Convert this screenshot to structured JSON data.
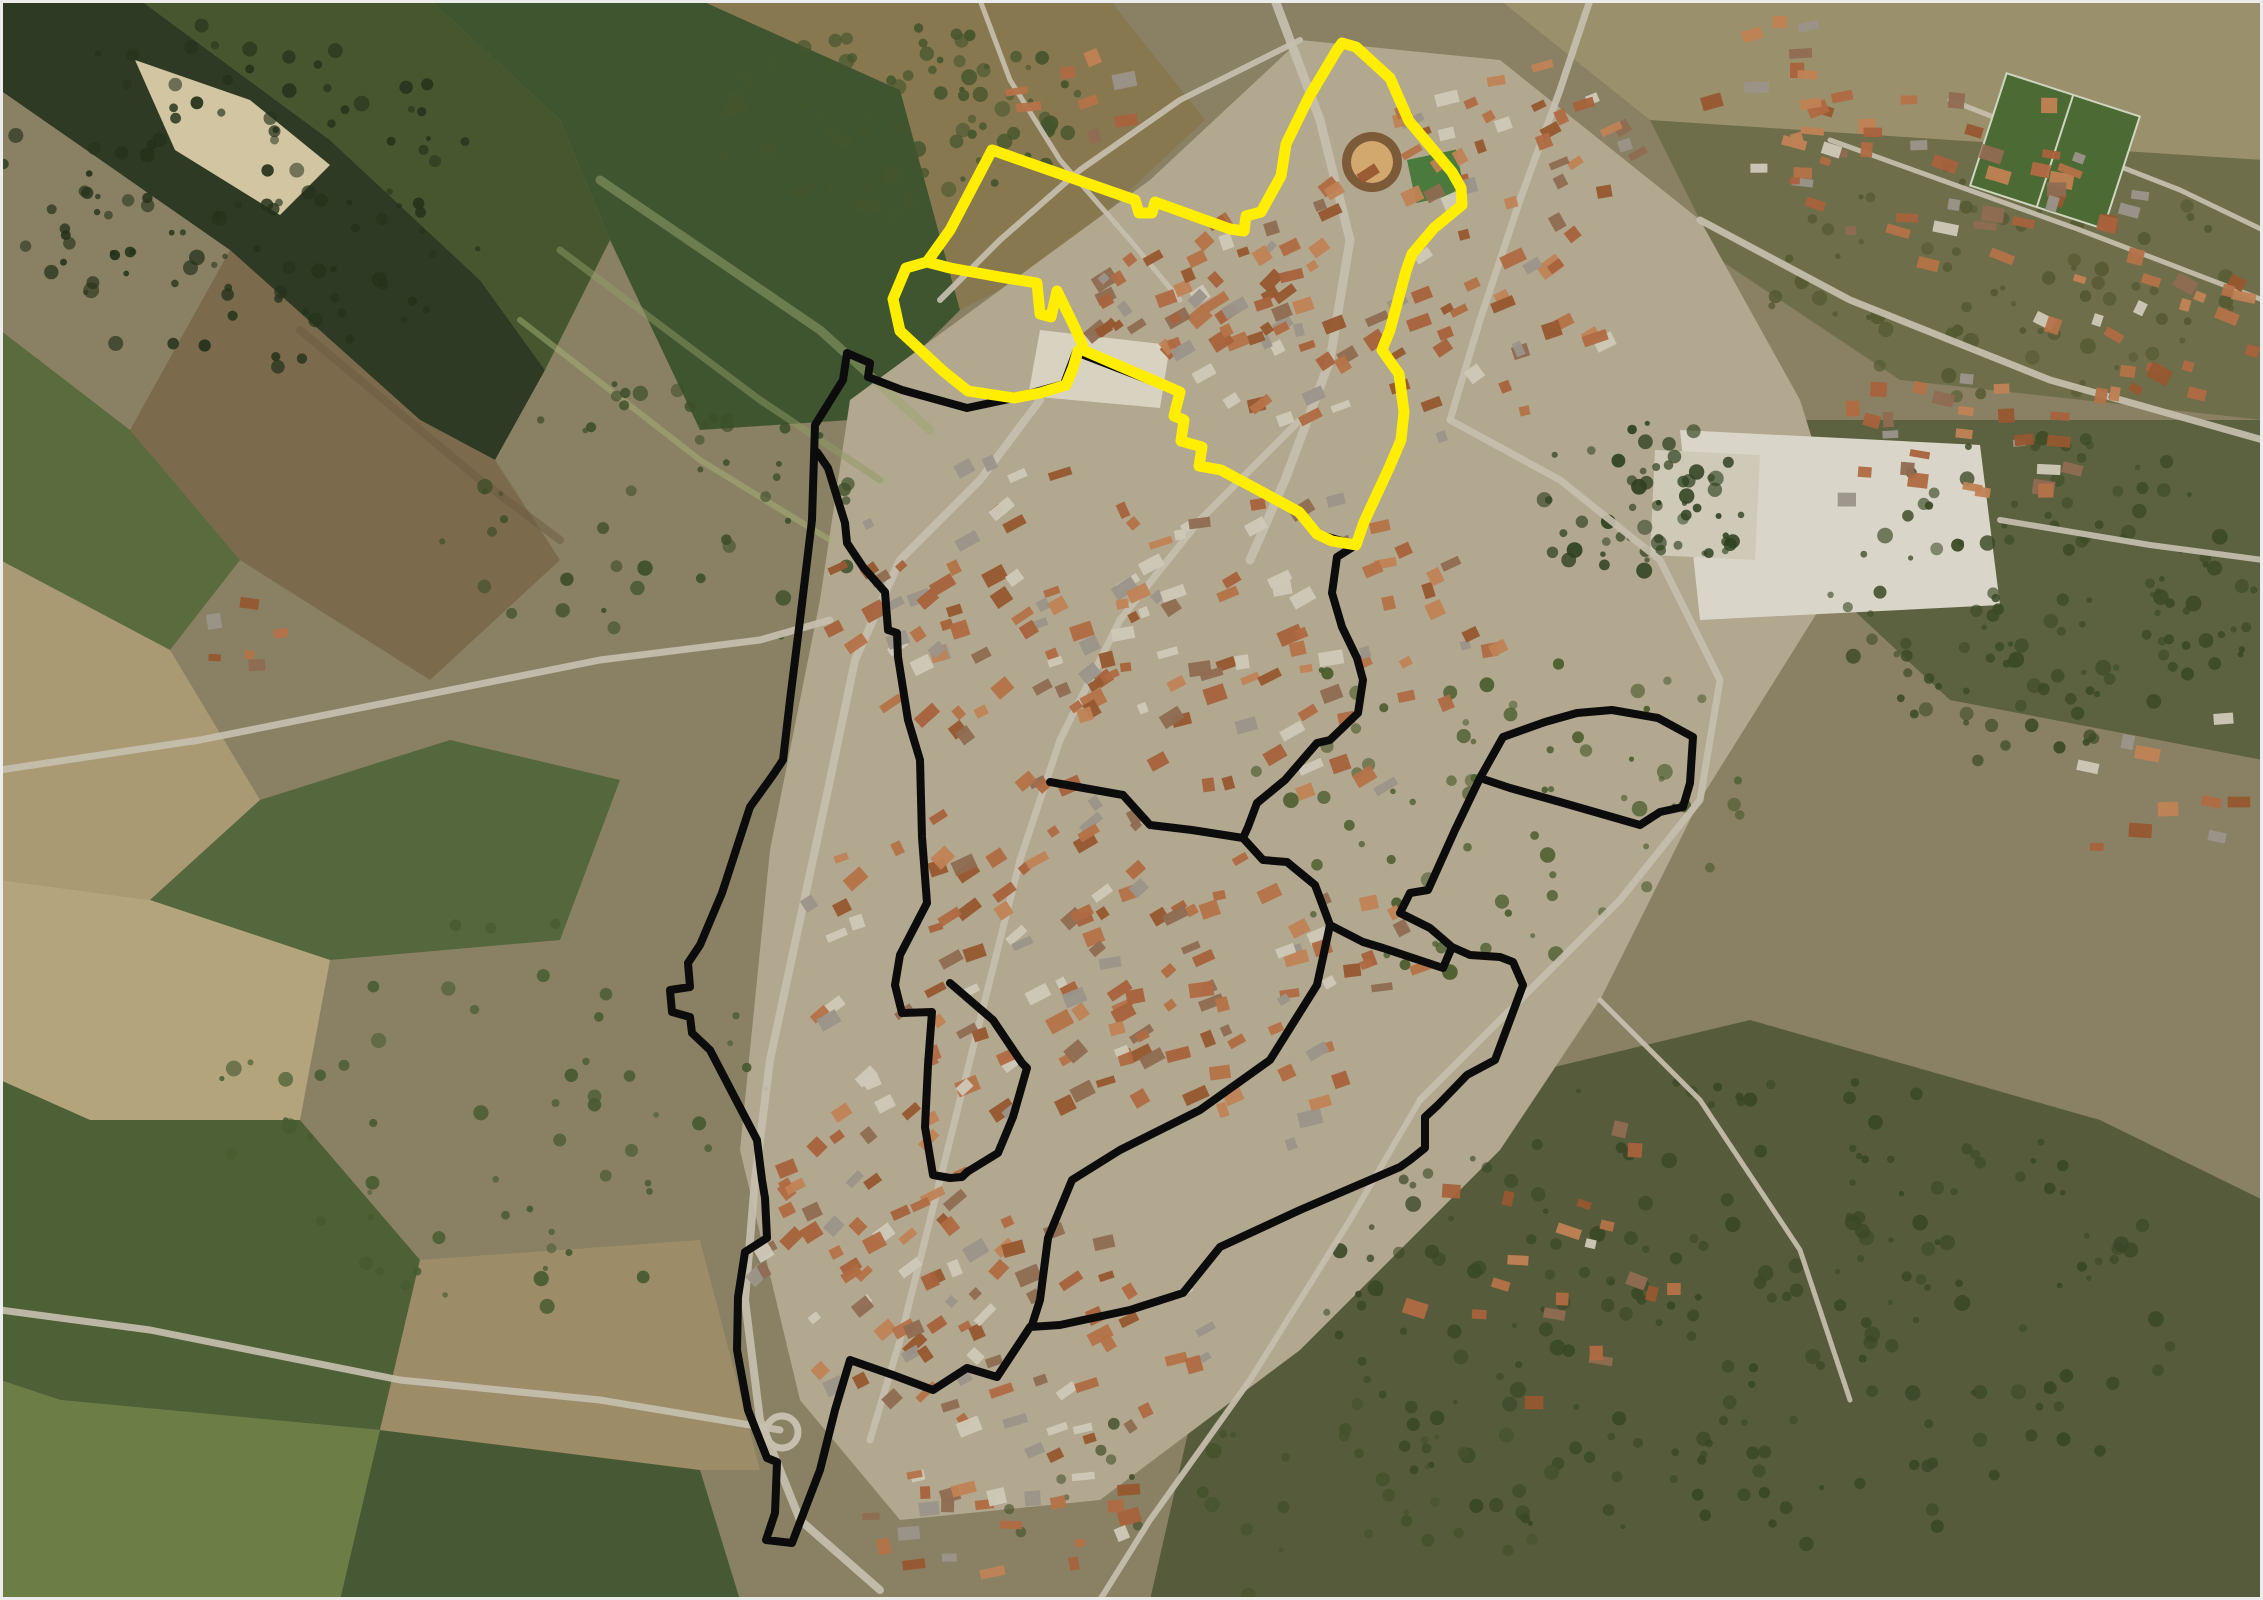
{
  "meta": {
    "kind": "aerial-satellite-map",
    "width": 2263,
    "height": 1600,
    "frame_border_color": "#ececec"
  },
  "palette": {
    "base": "#8a8164",
    "roads": "#c6bfae",
    "road_minor": "#bdb5a3",
    "roof_colors": [
      "#a8623c",
      "#b57248",
      "#97572f",
      "#c08254",
      "#8f6b52",
      "#cfc8b8",
      "#9b948a",
      "#b06a42"
    ],
    "tree_dark": "#32441f",
    "tree_mid": "#4a5c2d",
    "boundary_yellow": "#ffee00",
    "boundary_black": "#0c0c0c"
  },
  "map": {
    "regions": [
      {
        "name": "riparian-forest",
        "fill": "#2e3a24",
        "pts": "0,0 140,0 330,140 480,280 545,370 495,460 420,420 230,250 0,90"
      },
      {
        "name": "river-sandbar",
        "fill": "#d2c5a2",
        "pts": "135,60 250,100 330,165 280,215 175,150"
      },
      {
        "name": "green-field-nw",
        "fill": "#46572f",
        "pts": "140,0 430,0 560,120 610,240 545,370 480,280 330,140"
      },
      {
        "name": "green-field-north",
        "fill": "#3e5530",
        "pts": "430,0 700,0 900,90 960,310 850,420 700,430 610,240 560,120"
      },
      {
        "name": "orchard-plot-north",
        "fill": "#887850",
        "pts": "700,0 1110,0 1205,120 1050,265 960,310 900,90"
      },
      {
        "name": "plowed-field-west",
        "fill": "#7c6a4d",
        "pts": "230,250 420,420 495,460 560,560 430,680 240,560 130,430"
      },
      {
        "name": "green-strip-west",
        "fill": "#5a6b3d",
        "pts": "0,330 130,430 240,560 170,650 0,560"
      },
      {
        "name": "pale-field-west",
        "fill": "#a99a74",
        "pts": "0,560 170,650 260,800 150,900 0,880"
      },
      {
        "name": "green-field-west-mid",
        "fill": "#55673c",
        "pts": "260,800 450,740 620,780 560,940 330,960 150,900"
      },
      {
        "name": "pale-field-sw",
        "fill": "#b3a47c",
        "pts": "0,880 150,900 330,960 300,1120 90,1120 0,1080"
      },
      {
        "name": "green-field-sw1",
        "fill": "#4e6136",
        "pts": "0,1080 90,1120 300,1120 420,1260 380,1430 60,1400 0,1380"
      },
      {
        "name": "green-field-sw2",
        "fill": "#6d7d46",
        "pts": "0,1380 60,1400 380,1430 340,1600 0,1600"
      },
      {
        "name": "green-field-south",
        "fill": "#465934",
        "pts": "380,1430 700,1470 740,1600 340,1600"
      },
      {
        "name": "tan-fields-south",
        "fill": "#9c8d68",
        "pts": "420,1260 700,1240 760,1470 700,1470 380,1430"
      },
      {
        "name": "pale-field-ne",
        "fill": "#9b906c",
        "pts": "1500,0 2263,0 2263,160 1950,140 1650,120"
      },
      {
        "name": "scrub-ne",
        "fill": "#6f6e4a",
        "pts": "1650,120 1950,140 2263,160 2263,420 1900,380 1720,260"
      },
      {
        "name": "woods-east",
        "fill": "#5c6140",
        "pts": "1750,420 2263,420 2263,760 1950,700 1800,560"
      },
      {
        "name": "woods-southeast",
        "fill": "#565c3b",
        "pts": "1500,1080 1750,1020 2100,1120 2263,1200 2263,1600 1150,1600 1200,1380 1350,1220"
      },
      {
        "name": "town-ground",
        "fill": "#b2a78f",
        "pts": "850,400 1150,180 1300,40 1500,60 1700,220 1800,400 1850,560 1700,800 1600,1000 1500,1150 1300,1350 1100,1500 900,1520 800,1400 740,1150 770,850 820,600"
      },
      {
        "name": "central-plaza",
        "fill": "#d8d2c0",
        "pts": "1040,330 1170,345 1160,408 1028,396"
      },
      {
        "name": "school-complex",
        "fill": "#d9d6c9",
        "pts": "1680,430 1980,445 2000,605 1700,620"
      },
      {
        "name": "supermarket-lot",
        "fill": "#cfc9b8",
        "pts": "1655,450 1760,455 1755,560 1650,555"
      }
    ],
    "field_streaks": [
      {
        "name": "crop-row-streak",
        "stroke": "#9aa86f",
        "w": 9,
        "pts": "600,180 820,330 930,430"
      },
      {
        "name": "crop-row-streak",
        "stroke": "#8d9c64",
        "w": 7,
        "pts": "560,250 760,400 880,480"
      },
      {
        "name": "crop-row-streak",
        "stroke": "#a5b175",
        "w": 6,
        "pts": "520,320 700,460 830,540"
      },
      {
        "name": "plow-streak",
        "stroke": "#6b5a40",
        "w": 8,
        "pts": "300,330 480,480 560,540"
      }
    ],
    "roads": [
      {
        "name": "road-main-north",
        "w": 9,
        "pts": "1275,0 1320,120 1350,240 1330,360 1285,480 1250,560"
      },
      {
        "name": "road-west-bypass",
        "w": 8,
        "pts": "1040,400 980,480 900,560 855,660 830,780 800,920 770,1060 755,1180 745,1300 760,1420 800,1520 880,1590"
      },
      {
        "name": "road-inner-street",
        "w": 7,
        "pts": "1300,420 1200,520 1120,620 1060,740 1020,860 990,980 960,1100 930,1220 900,1340 870,1440"
      },
      {
        "name": "road-northeast-in",
        "w": 7,
        "pts": "1590,0 1560,90 1520,200 1480,320 1450,420"
      },
      {
        "name": "road-ne-diagonal",
        "w": 7,
        "pts": "1700,220 1850,300 2050,380 2263,440"
      },
      {
        "name": "road-ring-east",
        "w": 7,
        "pts": "1450,420 1560,480 1660,560 1720,680 1700,800 1620,900 1520,1000 1420,1100"
      },
      {
        "name": "road-west-out",
        "w": 7,
        "pts": "0,770 200,740 400,700 600,660 760,640 830,620"
      },
      {
        "name": "road-southwest-out",
        "w": 7,
        "pts": "780,1430 600,1400 400,1380 150,1330 0,1310"
      },
      {
        "name": "road-se-1",
        "w": 6,
        "pts": "1420,1100 1350,1220 1250,1380 1150,1520 1100,1600"
      },
      {
        "name": "road-se-2",
        "w": 5,
        "pts": "1600,1000 1700,1100 1800,1250 1850,1400"
      },
      {
        "name": "road-farm-top",
        "w": 5,
        "pts": "980,0 1010,80 1060,160 1130,240 1180,300"
      },
      {
        "name": "road-ne-suburb-1",
        "w": 5,
        "pts": "1830,140 2080,230 2263,300"
      },
      {
        "name": "road-ne-suburb-2",
        "w": 5,
        "pts": "1950,100 2180,190 2263,230"
      },
      {
        "name": "road-school-east",
        "w": 6,
        "pts": "2000,520 2150,545 2263,560"
      },
      {
        "name": "road-top-center",
        "w": 6,
        "pts": "1300,40 1180,100 1080,170 1000,240 940,300"
      }
    ],
    "landmarks": {
      "bullring": {
        "name": "bullring",
        "cx": 1372,
        "cy": 162,
        "r_outer": 30,
        "r_inner": 21,
        "ring_fill": "#7d5a38",
        "sand_fill": "#d2a86e"
      },
      "green_pitch": {
        "name": "small-green-pitch",
        "x": 1407,
        "y": 160,
        "w": 50,
        "h": 44,
        "fill": "#4a7a3c"
      },
      "soccer_field": {
        "name": "soccer-field",
        "x": 1985,
        "y": 92,
        "w": 140,
        "h": 118,
        "fill": "#4c6a34",
        "line": "#cfd6c0"
      },
      "roundabout": {
        "name": "roundabout",
        "cx": 782,
        "cy": 1432,
        "r": 16,
        "stroke": "#c6bfae"
      }
    },
    "building_clusters": [
      {
        "name": "town-street-row-north",
        "cx": 1200,
        "cy": 300,
        "rx": 130,
        "ry": 70,
        "n": 35,
        "ang": -35,
        "seed": 11
      },
      {
        "name": "town-core-north",
        "cx": 1390,
        "cy": 300,
        "rx": 230,
        "ry": 150,
        "n": 80,
        "ang": -25,
        "seed": 12
      },
      {
        "name": "town-mid-west",
        "cx": 1000,
        "cy": 600,
        "rx": 180,
        "ry": 140,
        "n": 70,
        "ang": -30,
        "seed": 13
      },
      {
        "name": "town-mid-east",
        "cx": 1300,
        "cy": 650,
        "rx": 200,
        "ry": 160,
        "n": 70,
        "ang": -20,
        "seed": 14
      },
      {
        "name": "town-south-1",
        "cx": 1000,
        "cy": 950,
        "rx": 200,
        "ry": 180,
        "n": 85,
        "ang": -30,
        "seed": 15
      },
      {
        "name": "town-south-2",
        "cx": 1250,
        "cy": 1000,
        "rx": 180,
        "ry": 150,
        "n": 55,
        "ang": -20,
        "seed": 16
      },
      {
        "name": "town-sw-tail",
        "cx": 880,
        "cy": 1250,
        "rx": 130,
        "ry": 180,
        "n": 60,
        "ang": -35,
        "seed": 17
      },
      {
        "name": "town-s-tail",
        "cx": 1050,
        "cy": 1350,
        "rx": 160,
        "ry": 120,
        "n": 40,
        "ang": -25,
        "seed": 18
      },
      {
        "name": "suburb-ne-1",
        "cx": 1950,
        "cy": 180,
        "rx": 200,
        "ry": 90,
        "n": 45,
        "ang": 10,
        "seed": 19
      },
      {
        "name": "suburb-ne-2",
        "cx": 2150,
        "cy": 330,
        "rx": 110,
        "ry": 80,
        "n": 25,
        "ang": 20,
        "seed": 20
      },
      {
        "name": "apartment-blocks-east",
        "cx": 1950,
        "cy": 450,
        "rx": 140,
        "ry": 80,
        "n": 28,
        "ang": 5,
        "seed": 21
      },
      {
        "name": "village-north",
        "cx": 1520,
        "cy": 130,
        "rx": 140,
        "ry": 80,
        "n": 30,
        "ang": -20,
        "seed": 22
      },
      {
        "name": "farm-north",
        "cx": 1075,
        "cy": 95,
        "rx": 60,
        "ry": 50,
        "n": 8,
        "ang": -15,
        "seed": 23
      },
      {
        "name": "houses-far-east",
        "cx": 2150,
        "cy": 770,
        "rx": 110,
        "ry": 90,
        "n": 10,
        "ang": 0,
        "seed": 24
      },
      {
        "name": "houses-se-sparse",
        "cx": 1600,
        "cy": 1270,
        "rx": 200,
        "ry": 150,
        "n": 20,
        "ang": 10,
        "seed": 25
      },
      {
        "name": "houses-bottom",
        "cx": 1000,
        "cy": 1520,
        "rx": 150,
        "ry": 60,
        "n": 25,
        "ang": -10,
        "seed": 26
      },
      {
        "name": "hamlet-west",
        "cx": 260,
        "cy": 650,
        "rx": 80,
        "ry": 50,
        "n": 6,
        "ang": 0,
        "seed": 27
      },
      {
        "name": "houses-ne-far",
        "cx": 1780,
        "cy": 80,
        "rx": 90,
        "ry": 60,
        "n": 12,
        "ang": -10,
        "seed": 28
      }
    ],
    "tree_zones": [
      {
        "name": "riparian-trees",
        "cx": 240,
        "cy": 200,
        "rx": 250,
        "ry": 180,
        "n": 120,
        "fill": "#25331b",
        "seed": 31
      },
      {
        "name": "east-woods-trees",
        "cx": 2050,
        "cy": 600,
        "rx": 220,
        "ry": 170,
        "n": 130,
        "fill": "#3c4a26",
        "seed": 32
      },
      {
        "name": "se-woods-trees",
        "cx": 1750,
        "cy": 1320,
        "rx": 430,
        "ry": 250,
        "n": 220,
        "fill": "#3a4826",
        "seed": 33
      },
      {
        "name": "central-park-trees",
        "cx": 1640,
        "cy": 500,
        "rx": 120,
        "ry": 80,
        "n": 60,
        "fill": "#2f4220",
        "seed": 34
      },
      {
        "name": "mid-scatter-trees",
        "cx": 1500,
        "cy": 800,
        "rx": 260,
        "ry": 180,
        "n": 70,
        "fill": "#4a5c2d",
        "seed": 35
      },
      {
        "name": "orchard-trees",
        "cx": 900,
        "cy": 120,
        "rx": 190,
        "ry": 100,
        "n": 90,
        "fill": "#44552c",
        "seed": 36
      },
      {
        "name": "sw-scatter-trees",
        "cx": 500,
        "cy": 1100,
        "rx": 280,
        "ry": 210,
        "n": 60,
        "fill": "#465a30",
        "seed": 37
      },
      {
        "name": "field-hedge-trees",
        "cx": 650,
        "cy": 520,
        "rx": 210,
        "ry": 150,
        "n": 50,
        "fill": "#3d4f29",
        "seed": 38
      },
      {
        "name": "bottom-scatter-trees",
        "cx": 1300,
        "cy": 1500,
        "rx": 300,
        "ry": 100,
        "n": 40,
        "fill": "#45522c",
        "seed": 39
      },
      {
        "name": "ne-scrub-trees",
        "cx": 2000,
        "cy": 280,
        "rx": 240,
        "ry": 120,
        "n": 70,
        "fill": "#52582f",
        "seed": 40
      }
    ],
    "boundaries": {
      "yellow": {
        "name": "yellow-zone-boundary",
        "color": "#ffee00",
        "stroke_width": 11,
        "paths": [
          "M992,150 L1135,200 L1139,213 L1152,213 L1155,202 L1230,229 L1244,231 L1246,216 L1261,212 L1281,176 L1286,144 L1309,97 L1337,50 L1342,43 L1356,47 L1390,78 L1409,121 L1452,172 L1461,188 L1462,205 L1434,228 L1412,254 L1406,271 L1390,330 L1382,350 L1399,374 L1404,412 L1401,440 L1389,468 L1364,522 L1356,545 L1332,541 L1317,534 L1299,512 L1221,470 L1199,466 L1202,447 L1181,441 L1184,420 L1174,416 L1180,392 L1085,351 L1076,330 L1057,291 L1051,317 L1040,314 L1037,283 L1000,277 L950,268 L927,262 L950,230 Z",
          "M927,262 L906,268 L893,299 L900,331 L943,371 L968,391 L1014,398 L1040,393 L1066,385 L1073,368 L1078,351"
        ]
      },
      "black": {
        "name": "black-zone-boundary",
        "color": "#0c0c0c",
        "stroke_width": 8,
        "paths": [
          "M847,353 L843,380 L815,425 L812,520 L800,620 L790,700 L783,760 L773,775 L750,807 L722,893 L700,945 L688,963 L690,987 L670,990 L672,1012 L690,1017 L692,1033 L710,1050 L757,1140 L762,1180 L765,1198 L767,1238 L745,1252 L738,1297 L737,1350 L748,1410 L767,1458 L777,1462 L775,1513 L766,1540 L792,1543 L820,1470 L835,1410 L850,1360 L893,1375 L933,1390 L967,1368 L997,1377 L1030,1327 L1060,1325 L1130,1310 L1183,1293 L1220,1247 L1300,1210 L1400,1167 L1410,1160 L1425,1148 L1425,1117 L1438,1105 L1467,1075 L1495,1060 L1510,1020 L1523,985 L1513,962 L1500,957 L1470,955 L1452,947 L1443,968 L1383,948 L1363,942 L1330,925 L1315,885 L1287,862 L1263,860 L1243,838 L1248,827 L1257,803 L1285,780 L1317,743 L1330,740 L1358,713 L1363,680 L1357,658 L1342,627 L1332,593 L1337,557 L1356,545 L1317,534 L1299,512 L1221,470 L1199,466 L1202,447 L1181,441 L1184,420 L1174,416 L1180,392 L1076,352 L1064,384 L1014,398 L967,408 L902,390 L868,377 L870,363 Z",
          "M1480,778 L1503,737 L1545,722 L1577,713 L1612,710 L1658,718 L1693,737 L1690,783 L1683,807 L1660,812 L1640,825 L1560,802 L1510,788 Z",
          "M1480,778 L1455,830 L1428,890 L1410,893 L1400,913 L1430,928 L1452,947",
          "M817,452 L828,468 L845,523 L847,543 L863,567 L885,592 L888,630 L897,633 L898,657 L908,720 L920,760 L922,837 L927,903 L900,955 L895,985 L902,1013 L932,1012 L928,1065 L925,1127 L933,1175 L950,1178 L962,1177 L967,1172 L998,1153 L1013,1117 L1027,1068 L1022,1063 L993,1020 L950,983",
          "M1050,782 L1123,795 L1150,825 L1192,830 L1243,838",
          "M1330,925 L1317,985 L1270,1060 L1200,1110 L1120,1150 L1072,1180 L1048,1238 L1040,1300 L1032,1325"
        ]
      }
    }
  }
}
